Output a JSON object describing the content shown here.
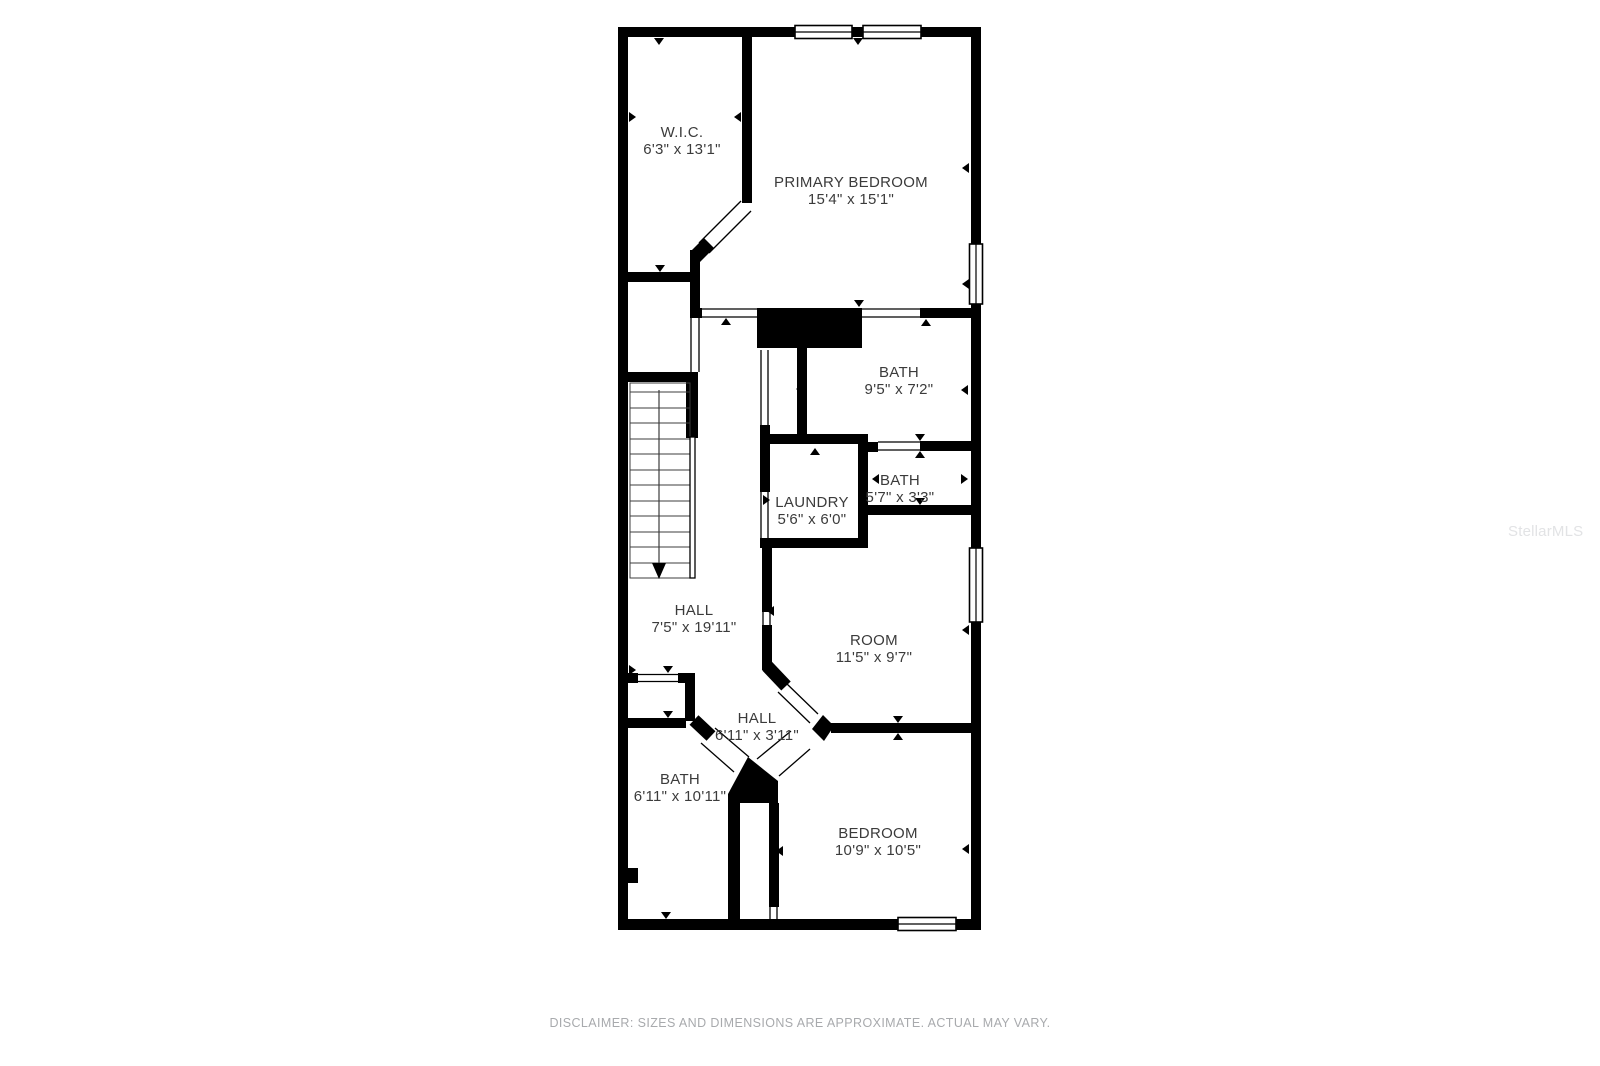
{
  "floorplan": {
    "rooms": [
      {
        "name": "W.I.C.",
        "dims": "6'3\" x 13'1\""
      },
      {
        "name": "PRIMARY BEDROOM",
        "dims": "15'4\" x 15'1\""
      },
      {
        "name": "BATH",
        "dims": "9'5\" x 7'2\""
      },
      {
        "name": "LAUNDRY",
        "dims": "5'6\" x 6'0\""
      },
      {
        "name": "BATH",
        "dims": "5'7\" x 3'3\""
      },
      {
        "name": "HALL",
        "dims": "7'5\" x 19'11\""
      },
      {
        "name": "ROOM",
        "dims": "11'5\" x 9'7\""
      },
      {
        "name": "HALL",
        "dims": "6'11\" x 3'11\""
      },
      {
        "name": "BATH",
        "dims": "6'11\" x 10'11\""
      },
      {
        "name": "BEDROOM",
        "dims": "10'9\" x 10'5\""
      }
    ],
    "disclaimer": "DISCLAIMER: SIZES AND DIMENSIONS ARE APPROXIMATE. ACTUAL MAY VARY.",
    "watermark": "StellarMLS",
    "colors": {
      "background": "#ffffff",
      "wall": "#000000",
      "room_label": "#3b3b3b",
      "disclaimer": "#a8aaad",
      "watermark": "#e2e3e5"
    }
  }
}
